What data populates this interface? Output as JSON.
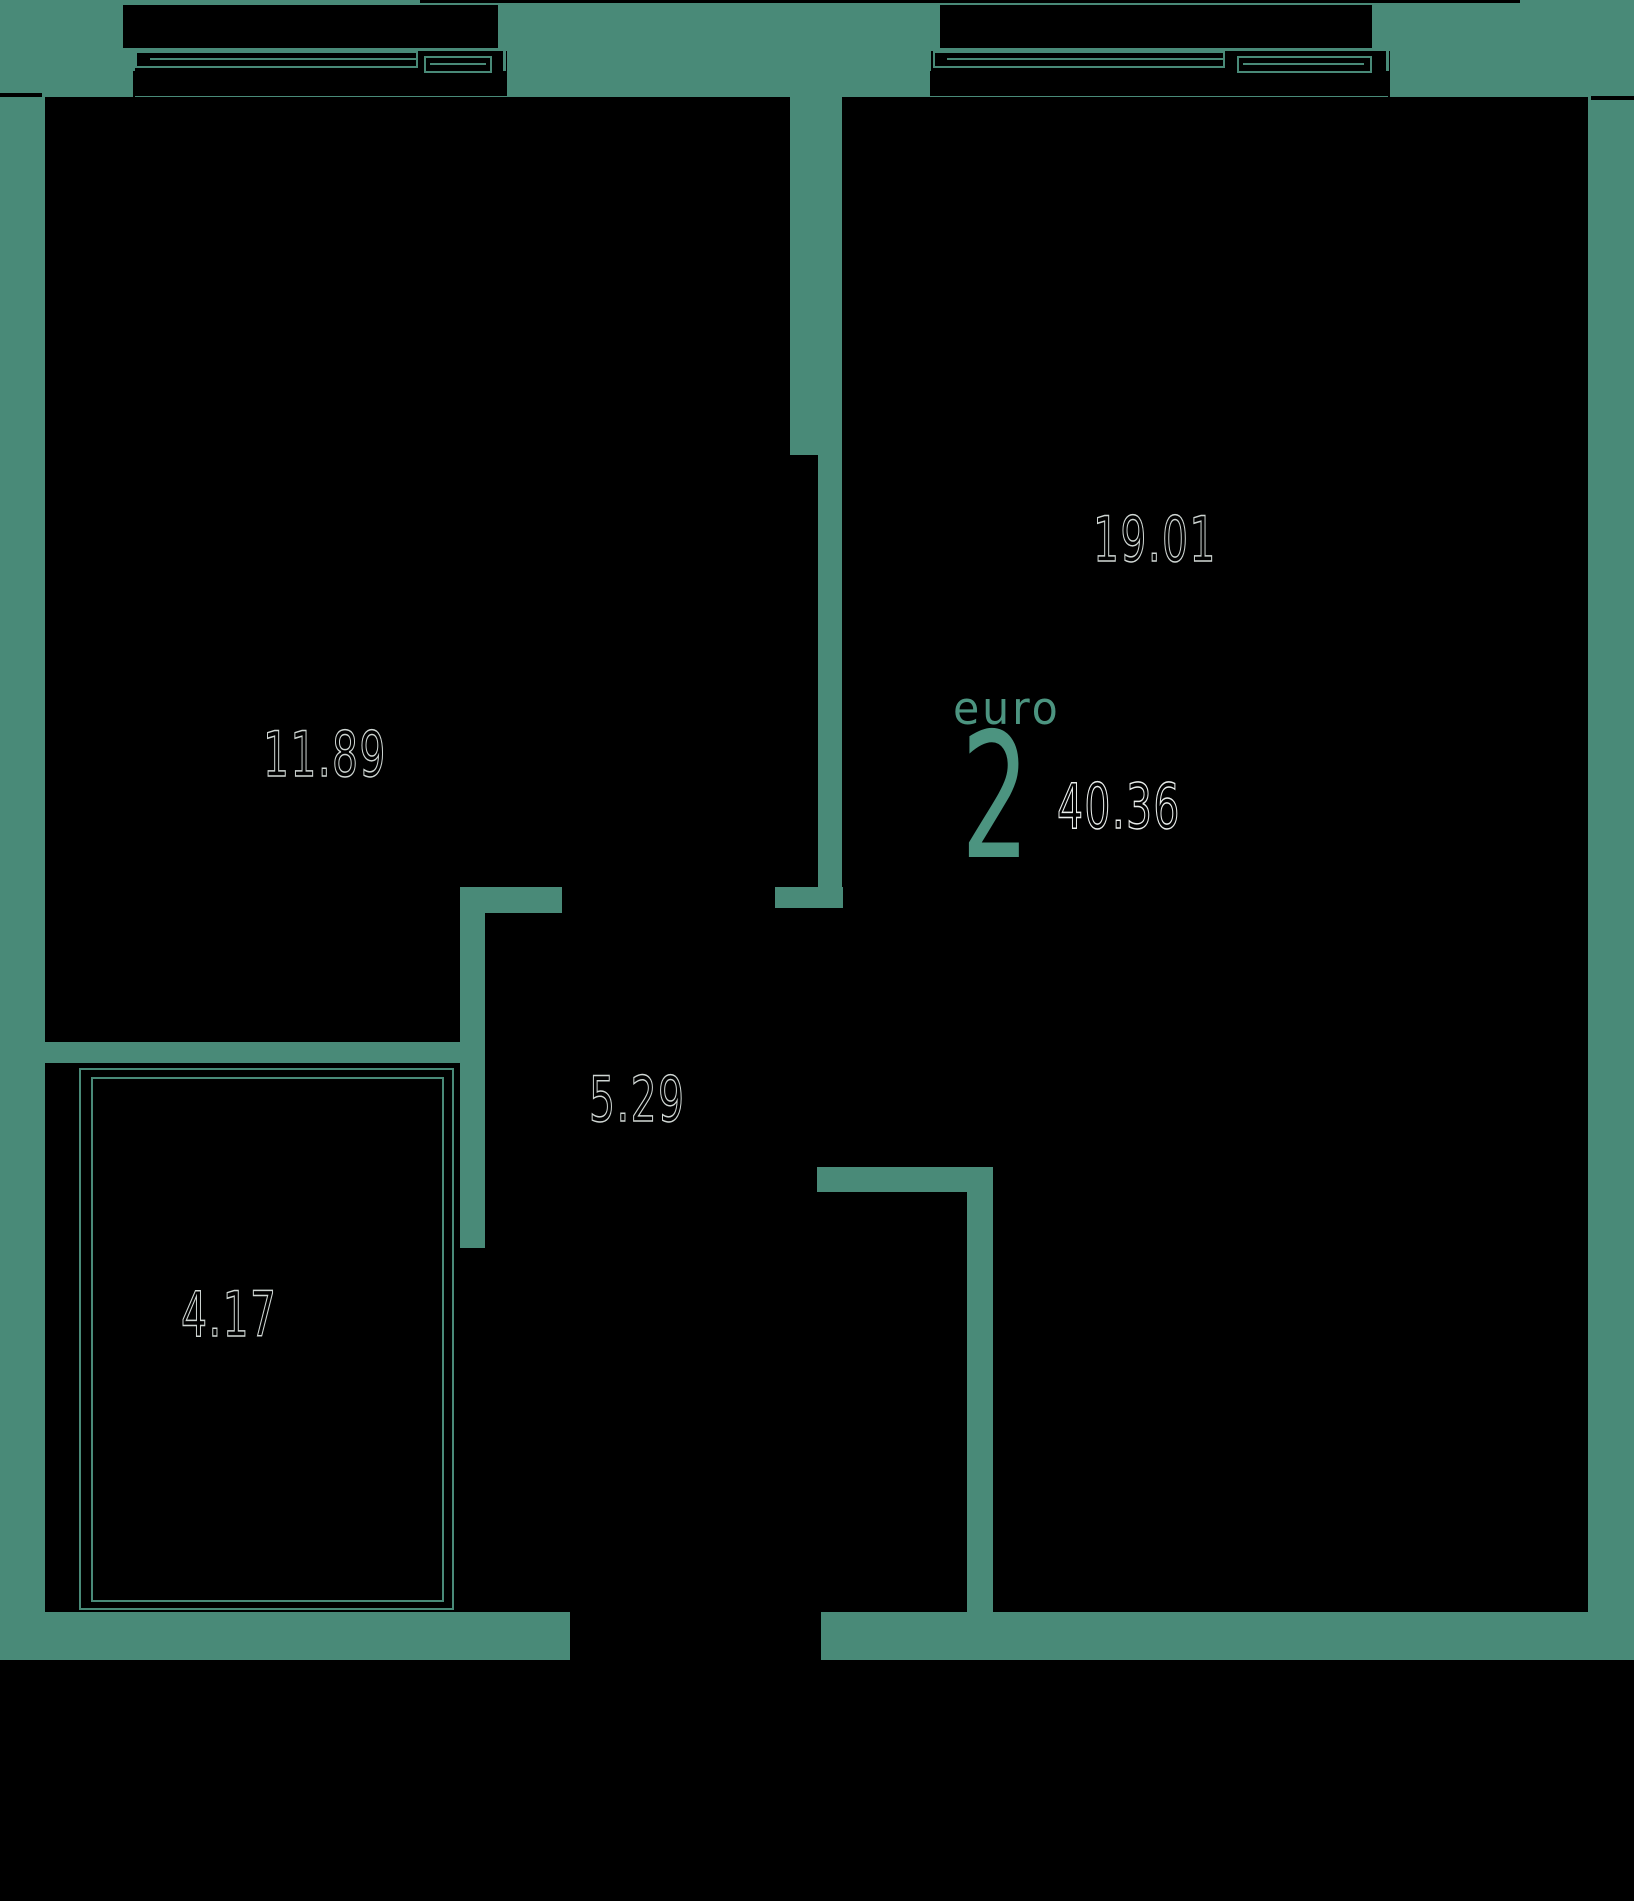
{
  "plan": {
    "summary": {
      "type_label": "euro",
      "rooms_count": "2",
      "total_area": "40.36"
    },
    "areas": {
      "living_kitchen": "19.01",
      "bedroom": "11.89",
      "hallway": "5.29",
      "bathroom": "4.17"
    },
    "colors": {
      "background": "#498A78",
      "walls_fill": "#000000",
      "area_number_outline": "#CFD6D3",
      "accent_text": "#4C9480"
    }
  }
}
